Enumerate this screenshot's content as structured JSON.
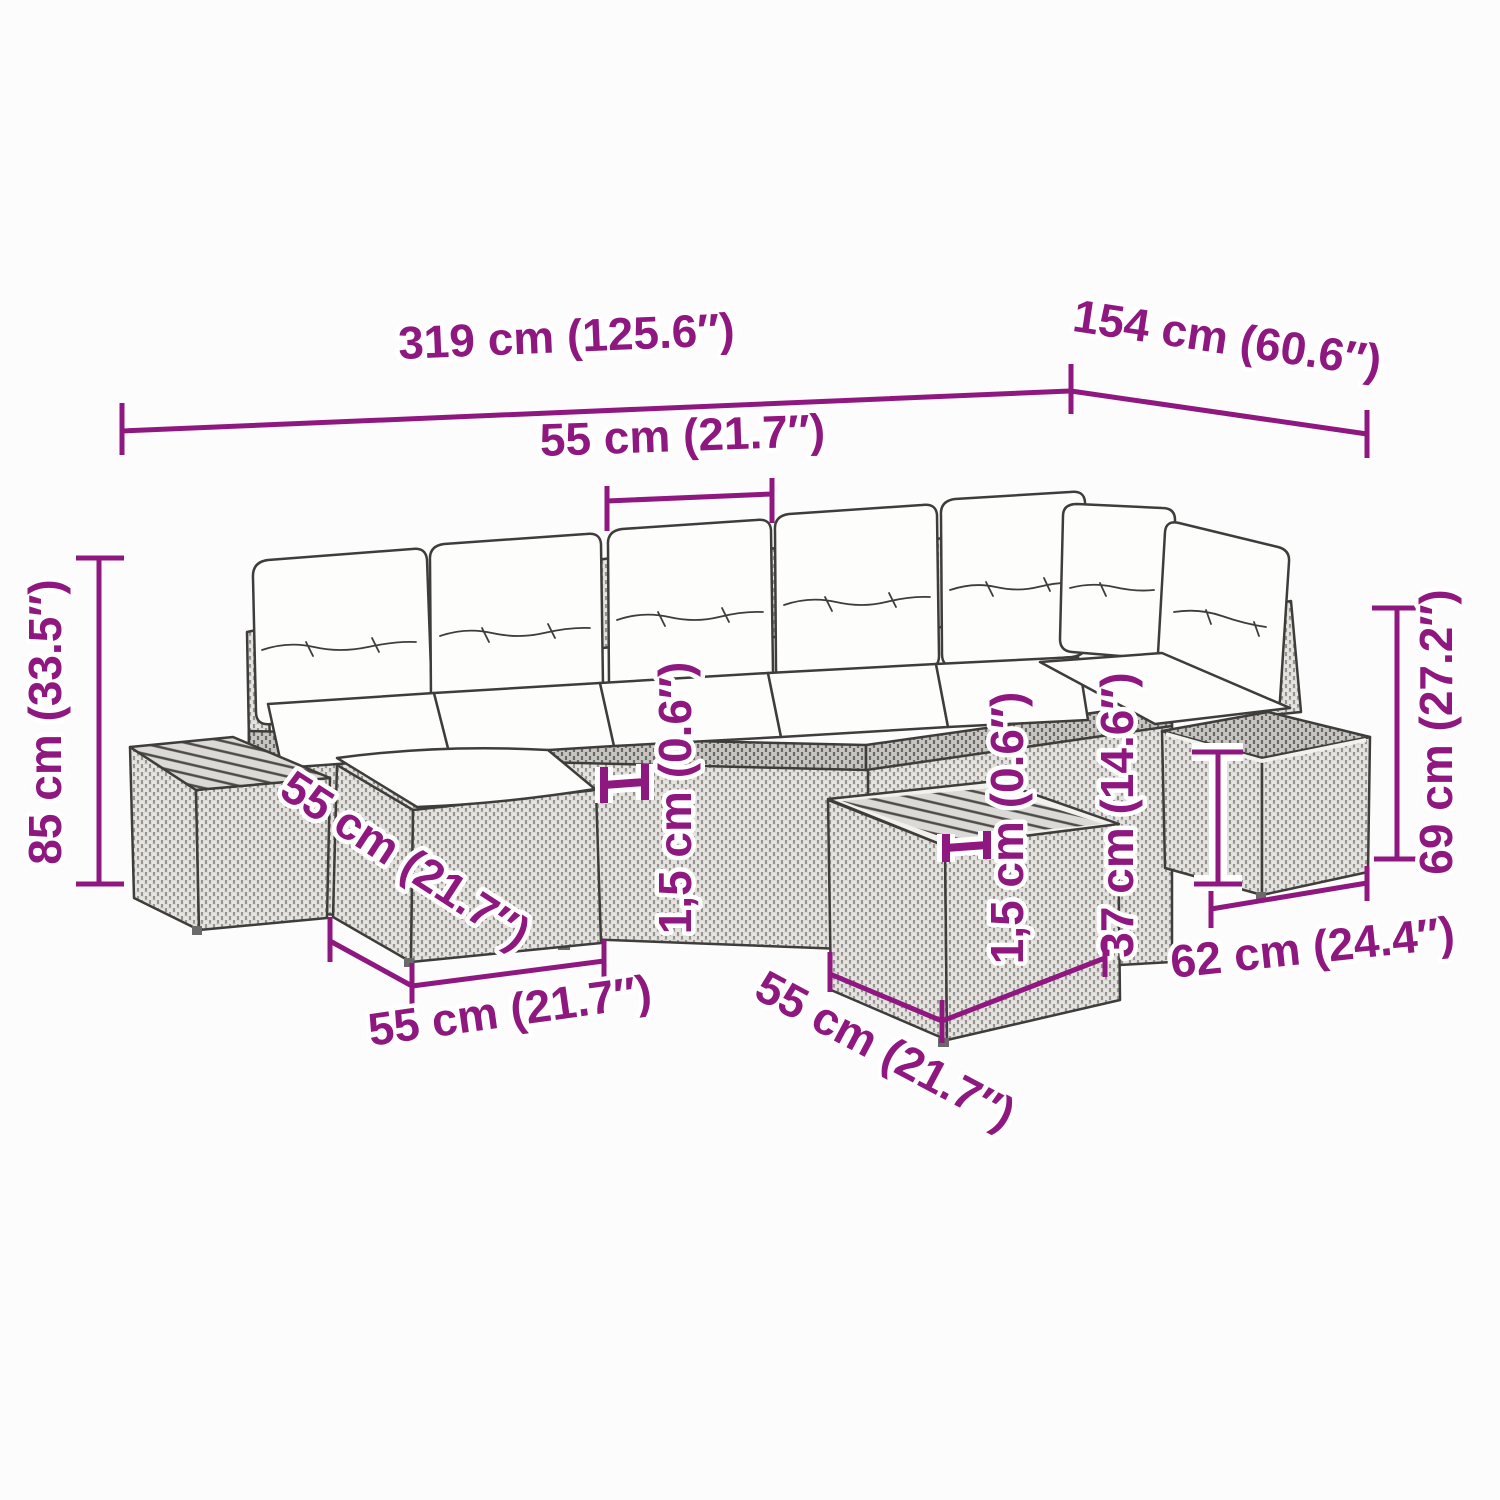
{
  "colors": {
    "accent": "#8e187f",
    "outline": "#3f3d3b",
    "background": "#fcfcfc",
    "cushion": "#fdfdfb",
    "rattan_light": "#e6e4e1",
    "rattan_dark": "#c9c7c3"
  },
  "dims": {
    "total_width": "319 cm (125.6″)",
    "total_depth": "154 cm (60.6″)",
    "back_cushion_width": "55 cm (21.7″)",
    "total_height": "85 cm (33.5″)",
    "stool_depth": "55 cm (21.7″)",
    "sofa_top_thickness": "1,5 cm (0.6″)",
    "stool_width": "55 cm (21.7″)",
    "table_top_thickness": "1,5 cm (0.6″)",
    "table_height": "37 cm (14.6″)",
    "table_width": "55 cm (21.7″)",
    "side_table_height": "69 cm (27.2″)",
    "side_table_width": "62 cm (24.4″)"
  }
}
